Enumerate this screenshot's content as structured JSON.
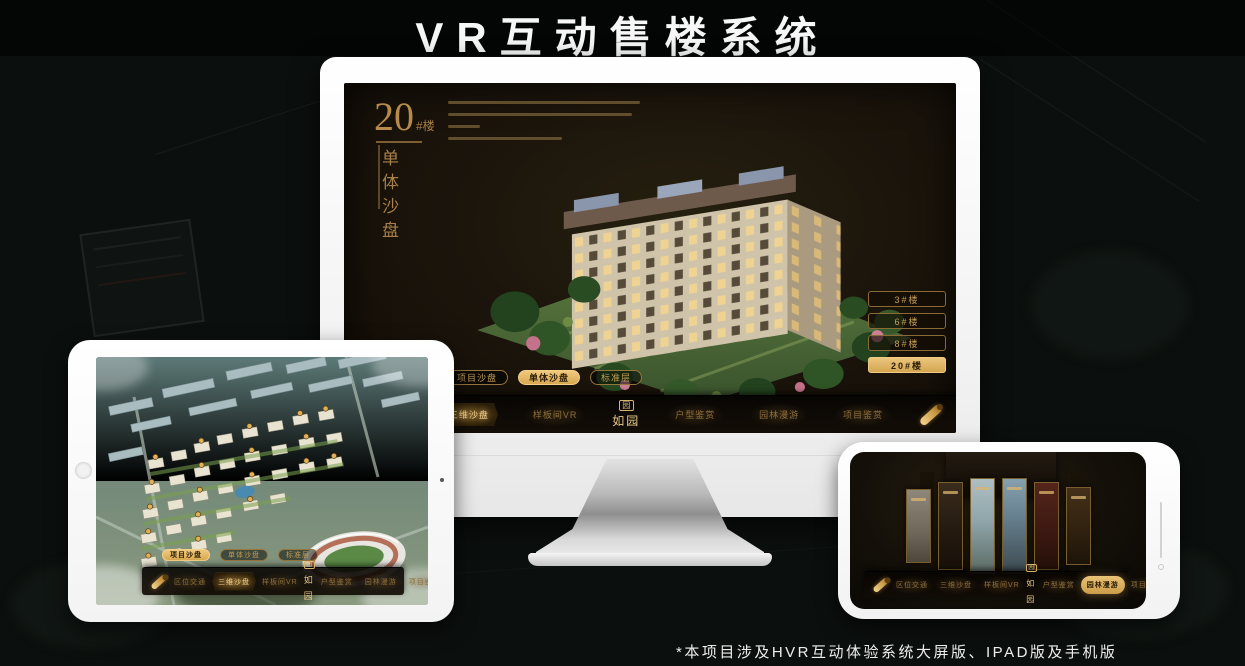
{
  "page": {
    "title": "VR互动售楼系统",
    "footnote": "*本项目涉及HVR互动体验系统大屏版、IPAD版及手机版"
  },
  "brand": {
    "mark": "园",
    "text": "如园"
  },
  "monitor": {
    "headline": {
      "number": "20",
      "suffix": "#楼",
      "subtitle": "单体沙盘"
    },
    "building_buttons": [
      {
        "label": "3#楼",
        "active": false
      },
      {
        "label": "6#楼",
        "active": false
      },
      {
        "label": "8#楼",
        "active": false
      },
      {
        "label": "20#楼",
        "active": true
      }
    ],
    "floor_tabs": [
      {
        "label": "项目沙盘",
        "active": false
      },
      {
        "label": "单体沙盘",
        "active": true
      },
      {
        "label": "标准层",
        "active": false
      }
    ],
    "nav_items": [
      {
        "label": "区位交通",
        "active": false
      },
      {
        "label": "三维沙盘",
        "active": true
      },
      {
        "label": "样板间VR",
        "active": false
      },
      {
        "label": "户型鉴赏",
        "active": false
      },
      {
        "label": "园林漫游",
        "active": false
      },
      {
        "label": "项目鉴赏",
        "active": false
      }
    ]
  },
  "tablet": {
    "floor_tabs": [
      {
        "label": "项目沙盘",
        "active": true
      },
      {
        "label": "单体沙盘",
        "active": false
      },
      {
        "label": "标准层",
        "active": false
      }
    ],
    "nav_items": [
      {
        "label": "区位交通",
        "active": false
      },
      {
        "label": "三维沙盘",
        "active": true
      },
      {
        "label": "样板间VR",
        "active": false
      },
      {
        "label": "户型鉴赏",
        "active": false
      },
      {
        "label": "园林漫游",
        "active": false
      },
      {
        "label": "项目鉴赏",
        "active": false
      }
    ]
  },
  "phone": {
    "nav_items": [
      {
        "label": "区位交通",
        "active": false
      },
      {
        "label": "三维沙盘",
        "active": false
      },
      {
        "label": "样板间VR",
        "active": false
      },
      {
        "label": "户型鉴赏",
        "active": false
      },
      {
        "label": "园林漫游",
        "active": true
      },
      {
        "label": "项目鉴赏",
        "active": false
      }
    ]
  },
  "accent_colors": {
    "gold": "#d8ab55",
    "gold_text": "#c09c55",
    "screen_dark": "#1c150c"
  }
}
